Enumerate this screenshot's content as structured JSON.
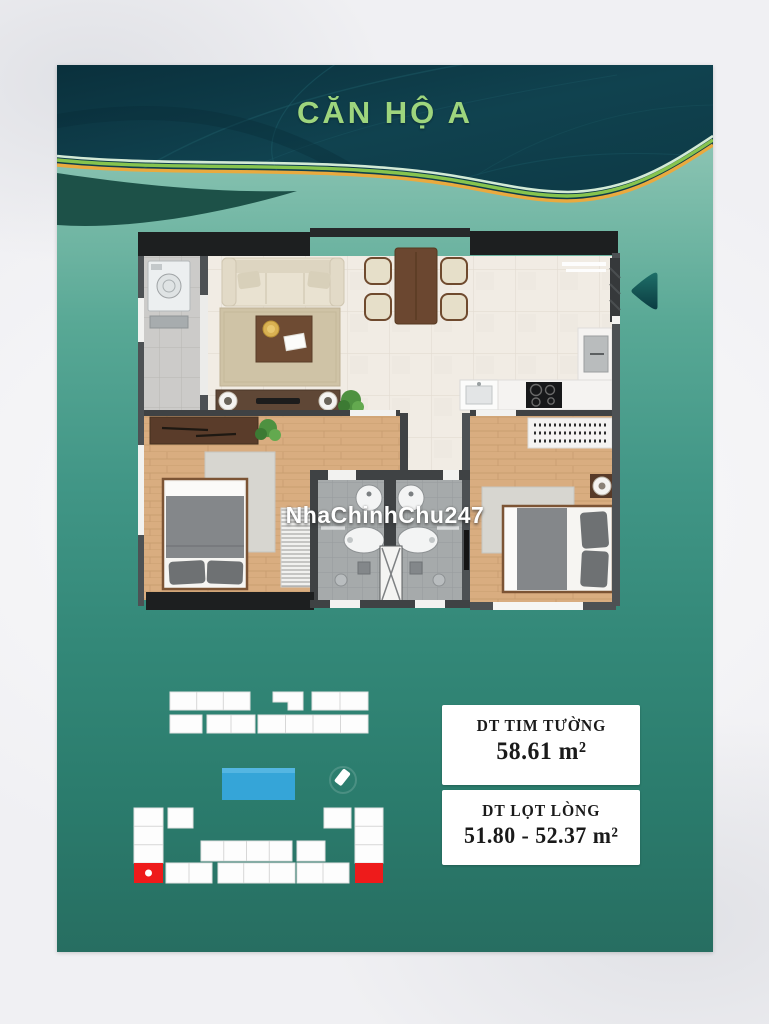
{
  "header": {
    "title": "CĂN HỘ A"
  },
  "watermark": {
    "text": "NhaChinhChu247"
  },
  "area_boxes": [
    {
      "label": "DT TIM TƯỜNG",
      "value": "58.61 m²"
    },
    {
      "label": "DT LỌT LÒNG",
      "value": "51.80 - 52.37 m²"
    }
  ],
  "icons": {
    "entrance_arrow": "left-pointing entrance arrow"
  },
  "colors": {
    "header_bg": "#0d3945",
    "title_green": "#9ed57d",
    "accent_gold": "#e9aa3f",
    "accent_green": "#86c44e",
    "accent_mint": "#d3ead6",
    "body_teal_top": "#a3d0c0",
    "body_teal_bottom": "#276e61",
    "pool_blue": "#35a5d8",
    "highlight_red": "#ee1b1b",
    "site_block_white": "#fdfdfd"
  }
}
